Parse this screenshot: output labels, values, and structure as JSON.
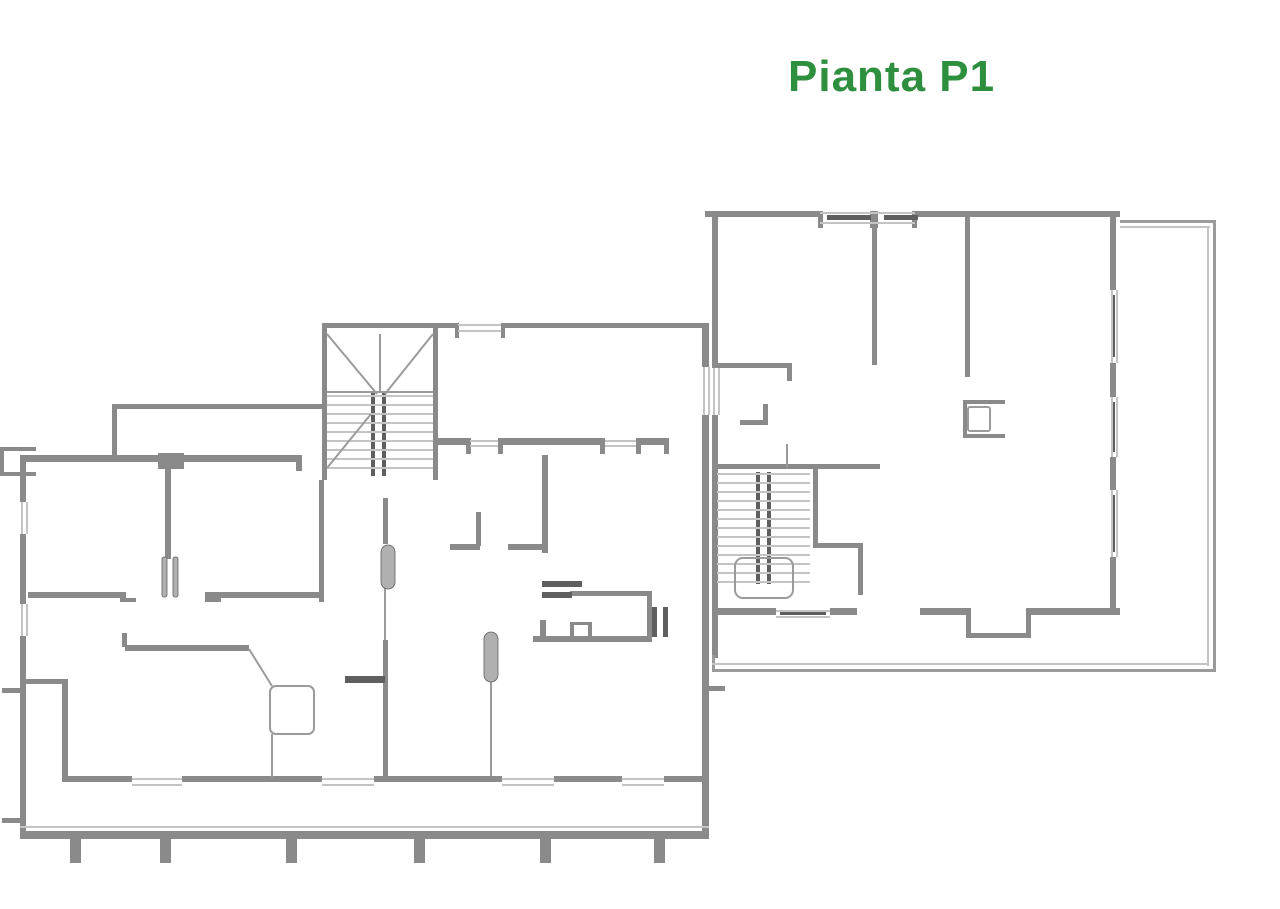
{
  "title": {
    "text": "Pianta P1",
    "color": "#2e8f3e"
  },
  "canvas": {
    "width": 1280,
    "height": 909,
    "background": "#ffffff"
  },
  "palette": {
    "wall": "#8a8a8a",
    "dark": "#5f5f5f",
    "thin": "#c4c4c4",
    "mid": "#9b9b9b",
    "leaf": "#b0b0b0"
  },
  "plan": {
    "groups": [
      {
        "name": "left-building-walls",
        "item_name": "wall-segment",
        "kind": "rect",
        "fill": "wall",
        "items": [
          [
            112,
            404,
            213,
            5
          ],
          [
            112,
            404,
            5,
            53
          ],
          [
            20,
            455,
            140,
            7
          ],
          [
            182,
            455,
            114,
            7
          ],
          [
            158,
            453,
            26,
            16
          ],
          [
            296,
            455,
            6,
            16
          ],
          [
            322,
            323,
            116,
            5
          ],
          [
            322,
            323,
            5,
            157
          ],
          [
            433,
            323,
            5,
            157
          ],
          [
            438,
            323,
            14,
            4
          ],
          [
            319,
            480,
            5,
            122
          ],
          [
            438,
            323,
            20,
            5
          ],
          [
            505,
            323,
            203,
            5
          ],
          [
            455,
            323,
            4,
            15
          ],
          [
            501,
            323,
            4,
            15
          ],
          [
            438,
            438,
            32,
            7
          ],
          [
            502,
            438,
            98,
            7
          ],
          [
            640,
            438,
            28,
            7
          ],
          [
            466,
            438,
            5,
            16
          ],
          [
            498,
            438,
            5,
            16
          ],
          [
            600,
            438,
            5,
            16
          ],
          [
            636,
            438,
            5,
            16
          ],
          [
            664,
            438,
            5,
            16
          ],
          [
            702,
            323,
            7,
            44
          ],
          [
            702,
            415,
            7,
            421
          ],
          [
            20,
            455,
            6,
            47
          ],
          [
            20,
            534,
            6,
            70
          ],
          [
            20,
            636,
            6,
            200
          ],
          [
            0,
            447,
            36,
            4
          ],
          [
            0,
            472,
            36,
            4
          ],
          [
            0,
            447,
            4,
            29
          ],
          [
            2,
            688,
            18,
            5
          ],
          [
            2,
            818,
            18,
            5
          ],
          [
            20,
            831,
            689,
            8
          ],
          [
            165,
            469,
            6,
            90
          ],
          [
            28,
            592,
            98,
            6
          ],
          [
            205,
            592,
            117,
            6
          ],
          [
            120,
            598,
            16,
            4
          ],
          [
            205,
            598,
            16,
            4
          ],
          [
            383,
            498,
            5,
            46
          ],
          [
            476,
            512,
            5,
            34
          ],
          [
            450,
            544,
            30,
            6
          ],
          [
            508,
            544,
            38,
            6
          ],
          [
            542,
            455,
            6,
            98
          ],
          [
            570,
            591,
            82,
            5
          ],
          [
            647,
            593,
            5,
            47
          ],
          [
            533,
            636,
            119,
            6
          ],
          [
            570,
            622,
            4,
            14
          ],
          [
            588,
            622,
            4,
            14
          ],
          [
            570,
            622,
            22,
            3
          ],
          [
            540,
            620,
            6,
            16
          ],
          [
            25,
            679,
            42,
            5
          ],
          [
            62,
            679,
            6,
            100
          ],
          [
            125,
            645,
            124,
            6
          ],
          [
            122,
            633,
            5,
            14
          ],
          [
            62,
            776,
            70,
            6
          ],
          [
            182,
            776,
            140,
            6
          ],
          [
            374,
            776,
            128,
            6
          ],
          [
            554,
            776,
            68,
            6
          ],
          [
            664,
            776,
            38,
            6
          ],
          [
            383,
            640,
            5,
            136
          ]
        ]
      },
      {
        "name": "right-building-walls",
        "item_name": "wall-segment",
        "kind": "rect",
        "fill": "wall",
        "items": [
          [
            705,
            211,
            115,
            6
          ],
          [
            915,
            211,
            205,
            6
          ],
          [
            1110,
            217,
            6,
            73
          ],
          [
            1110,
            363,
            6,
            34
          ],
          [
            1110,
            457,
            6,
            33
          ],
          [
            1110,
            557,
            6,
            55
          ],
          [
            818,
            211,
            5,
            17
          ],
          [
            912,
            211,
            5,
            17
          ],
          [
            870,
            211,
            8,
            17
          ],
          [
            712,
            211,
            6,
            157
          ],
          [
            712,
            415,
            6,
            243
          ],
          [
            712,
            608,
            64,
            7
          ],
          [
            830,
            608,
            27,
            7
          ],
          [
            920,
            608,
            50,
            7
          ],
          [
            1030,
            608,
            90,
            7
          ],
          [
            966,
            608,
            5,
            30
          ],
          [
            1026,
            608,
            5,
            30
          ],
          [
            966,
            633,
            65,
            5
          ],
          [
            872,
            217,
            5,
            148
          ],
          [
            965,
            217,
            5,
            160
          ],
          [
            712,
            363,
            80,
            5
          ],
          [
            787,
            363,
            5,
            18
          ],
          [
            740,
            420,
            28,
            5
          ],
          [
            763,
            404,
            5,
            21
          ],
          [
            963,
            400,
            42,
            4
          ],
          [
            963,
            434,
            42,
            4
          ],
          [
            963,
            400,
            4,
            38
          ],
          [
            712,
            464,
            168,
            5
          ],
          [
            813,
            464,
            5,
            84
          ],
          [
            813,
            543,
            50,
            5
          ],
          [
            858,
            543,
            5,
            52
          ],
          [
            703,
            686,
            22,
            5
          ],
          [
            703,
            686,
            4,
            14
          ]
        ]
      },
      {
        "name": "door-window-bars",
        "item_name": "detail-bar",
        "kind": "rect",
        "fill": "dark",
        "items": [
          [
            371,
            392,
            4,
            84
          ],
          [
            382,
            392,
            4,
            84
          ],
          [
            756,
            472,
            4,
            112
          ],
          [
            767,
            472,
            4,
            112
          ],
          [
            652,
            607,
            5,
            30
          ],
          [
            663,
            607,
            5,
            30
          ],
          [
            542,
            581,
            40,
            6
          ],
          [
            542,
            592,
            30,
            6
          ],
          [
            345,
            676,
            40,
            7
          ],
          [
            827,
            215,
            44,
            5
          ],
          [
            884,
            215,
            34,
            5
          ],
          [
            1112,
            295,
            3,
            62
          ],
          [
            1112,
            402,
            3,
            50
          ],
          [
            1112,
            495,
            3,
            57
          ],
          [
            780,
            611,
            46,
            4
          ]
        ]
      },
      {
        "name": "window-lines",
        "item_name": "window-line",
        "kind": "rect",
        "fill": "thin",
        "items": [
          [
            458,
            324,
            43,
            2
          ],
          [
            458,
            330,
            43,
            2
          ],
          [
            470,
            440,
            28,
            2
          ],
          [
            470,
            445,
            28,
            2
          ],
          [
            605,
            440,
            31,
            2
          ],
          [
            605,
            445,
            31,
            2
          ],
          [
            703,
            367,
            2,
            48
          ],
          [
            708,
            367,
            2,
            48
          ],
          [
            21,
            502,
            2,
            32
          ],
          [
            26,
            502,
            2,
            32
          ],
          [
            21,
            604,
            2,
            32
          ],
          [
            26,
            604,
            2,
            32
          ],
          [
            20,
            826,
            689,
            2
          ],
          [
            132,
            778,
            50,
            2
          ],
          [
            132,
            784,
            50,
            2
          ],
          [
            322,
            778,
            52,
            2
          ],
          [
            322,
            784,
            52,
            2
          ],
          [
            502,
            778,
            52,
            2
          ],
          [
            502,
            784,
            52,
            2
          ],
          [
            622,
            778,
            42,
            2
          ],
          [
            622,
            784,
            42,
            2
          ],
          [
            1111,
            290,
            2,
            73
          ],
          [
            1116,
            290,
            2,
            73
          ],
          [
            1111,
            397,
            2,
            60
          ],
          [
            1116,
            397,
            2,
            60
          ],
          [
            1111,
            490,
            2,
            67
          ],
          [
            1116,
            490,
            2,
            67
          ],
          [
            820,
            212,
            95,
            2
          ],
          [
            820,
            222,
            95,
            2
          ],
          [
            713,
            368,
            2,
            47
          ],
          [
            718,
            368,
            2,
            47
          ],
          [
            776,
            610,
            54,
            2
          ],
          [
            776,
            616,
            54,
            2
          ]
        ]
      },
      {
        "name": "terrace-outline",
        "item_name": "terrace-line",
        "kind": "rect",
        "fill": "mid",
        "items": [
          [
            1120,
            220,
            96,
            3
          ],
          [
            1213,
            220,
            3,
            452
          ],
          [
            712,
            669,
            504,
            3
          ],
          [
            712,
            655,
            3,
            17
          ]
        ]
      },
      {
        "name": "terrace-inner-lines",
        "item_name": "terrace-line",
        "kind": "rect",
        "fill": "thin",
        "items": [
          [
            1120,
            226,
            90,
            2
          ],
          [
            1207,
            226,
            2,
            440
          ],
          [
            712,
            663,
            497,
            2
          ]
        ]
      },
      {
        "name": "balcony-posts",
        "item_name": "railing-post",
        "kind": "rect",
        "fill": "wall",
        "items": [
          [
            70,
            839,
            11,
            24
          ],
          [
            160,
            839,
            11,
            24
          ],
          [
            286,
            839,
            11,
            24
          ],
          [
            414,
            839,
            11,
            24
          ],
          [
            540,
            839,
            11,
            24
          ],
          [
            654,
            839,
            11,
            24
          ]
        ]
      },
      {
        "name": "left-stair-treads",
        "item_name": "stair-tread",
        "kind": "line",
        "stroke": "thin",
        "width": 2,
        "items": [
          [
            327,
            396,
            433,
            396
          ],
          [
            327,
            405,
            433,
            405
          ],
          [
            327,
            414,
            433,
            414
          ],
          [
            327,
            423,
            433,
            423
          ],
          [
            327,
            432,
            433,
            432
          ],
          [
            327,
            441,
            433,
            441
          ],
          [
            327,
            450,
            433,
            450
          ],
          [
            327,
            459,
            433,
            459
          ],
          [
            327,
            468,
            433,
            468
          ]
        ]
      },
      {
        "name": "right-stair-treads",
        "item_name": "stair-tread",
        "kind": "line",
        "stroke": "thin",
        "width": 2,
        "items": [
          [
            717,
            474,
            810,
            474
          ],
          [
            717,
            483,
            810,
            483
          ],
          [
            717,
            492,
            810,
            492
          ],
          [
            717,
            501,
            810,
            501
          ],
          [
            717,
            510,
            810,
            510
          ],
          [
            717,
            519,
            810,
            519
          ],
          [
            717,
            528,
            810,
            528
          ],
          [
            717,
            537,
            810,
            537
          ],
          [
            717,
            546,
            810,
            546
          ],
          [
            717,
            555,
            810,
            555
          ],
          [
            717,
            564,
            810,
            564
          ],
          [
            717,
            573,
            810,
            573
          ],
          [
            717,
            582,
            810,
            582
          ]
        ]
      },
      {
        "name": "construction-lines",
        "item_name": "plan-line",
        "kind": "line",
        "stroke": "mid",
        "width": 2,
        "items": [
          [
            327,
            334,
            377,
            394
          ],
          [
            433,
            334,
            385,
            394
          ],
          [
            327,
            468,
            371,
            414
          ],
          [
            380,
            334,
            380,
            392
          ],
          [
            327,
            392,
            433,
            392
          ],
          [
            249,
            649,
            272,
            686
          ],
          [
            272,
            734,
            272,
            777
          ],
          [
            491,
            680,
            491,
            776
          ],
          [
            385,
            587,
            385,
            640
          ],
          [
            787,
            444,
            787,
            468
          ]
        ]
      },
      {
        "name": "door-leaves",
        "item_name": "door-leaf",
        "kind": "leaf",
        "fill": "leaf",
        "items": [
          [
            162,
            557,
            5,
            40,
            2
          ],
          [
            173,
            557,
            5,
            40,
            2
          ],
          [
            381,
            545,
            14,
            44,
            7
          ],
          [
            484,
            632,
            14,
            50,
            7
          ]
        ]
      },
      {
        "name": "fixture-outlines",
        "item_name": "fixture-outline",
        "kind": "stroke-rect",
        "stroke": "mid",
        "width": 2,
        "items": [
          [
            270,
            686,
            44,
            48,
            6
          ],
          [
            968,
            407,
            22,
            24,
            2
          ],
          [
            735,
            558,
            58,
            40,
            8
          ]
        ]
      }
    ]
  }
}
